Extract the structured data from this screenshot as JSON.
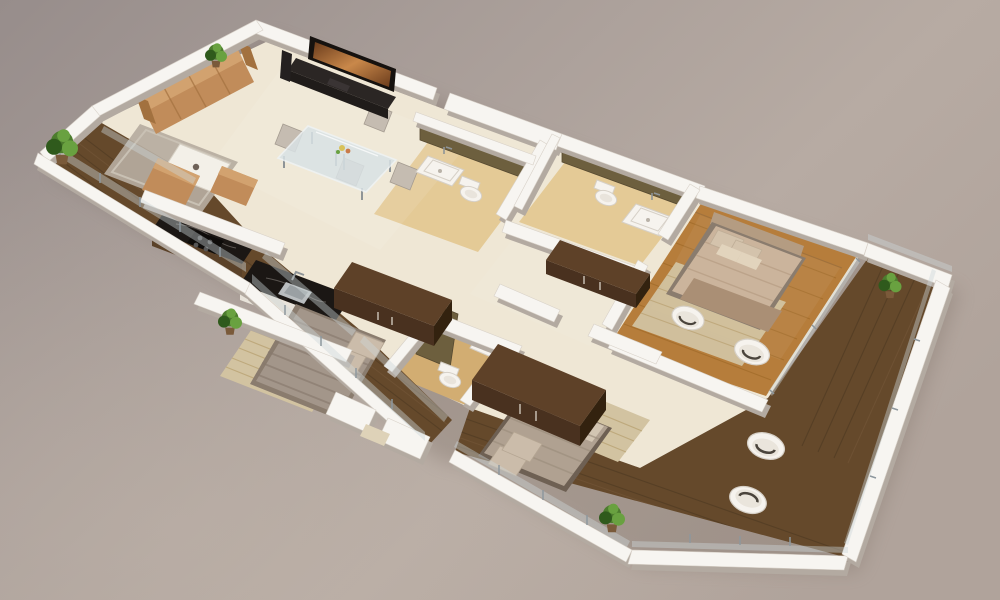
{
  "scene": {
    "title": "3D isometric cutaway floor plan render of a three-bedroom apartment",
    "style": "photorealistic architectural visualization, top-down isometric view on plain studio backdrop",
    "rooms": [
      {
        "id": "living-room",
        "label": "Living Room"
      },
      {
        "id": "dining-area",
        "label": "Dining Area"
      },
      {
        "id": "kitchen",
        "label": "Kitchen"
      },
      {
        "id": "master-bedroom",
        "label": "Master Bedroom"
      },
      {
        "id": "bedroom-2",
        "label": "Bedroom 2"
      },
      {
        "id": "bedroom-3",
        "label": "Bedroom 3"
      },
      {
        "id": "bathroom-1",
        "label": "Bathroom 1"
      },
      {
        "id": "bathroom-2",
        "label": "Bathroom 2"
      },
      {
        "id": "bathroom-3",
        "label": "Bathroom 3"
      },
      {
        "id": "balcony-west",
        "label": "West Balcony Terrace"
      },
      {
        "id": "balcony-southeast",
        "label": "Wrap-around South-East Balcony"
      },
      {
        "id": "entrance",
        "label": "Entrance Step"
      }
    ],
    "furniture": [
      "tan four-seat sofa",
      "tan armchair",
      "tan ottoman",
      "white coffee table",
      "gray area rug",
      "wall-mounted flat TV",
      "dark media cabinet",
      "floor speaker",
      "glass dining table",
      "four beige dining chairs",
      "flower centerpiece",
      "black granite kitchen counters",
      "steel sink",
      "cooktop hob",
      "three double beds with beige bedding",
      "woven bed rugs",
      "three dark-brown wardrobes",
      "hall console",
      "four white tub chairs",
      "three toilets",
      "two shower trays",
      "wash basin",
      "five green potted plants",
      "glass balcony railings"
    ],
    "counts": {
      "bedrooms": 3,
      "bathrooms": 3,
      "balconies": 3,
      "plants": 5,
      "tub_chairs": 4
    }
  },
  "colors": {
    "bg-1": "#978d8b",
    "bg-2": "#a89d98",
    "bg-3": "#b7aba3",
    "bg-4": "#b0a39b",
    "bg-light": "#c8bcb0",
    "ground-shadow": "#6f6258",
    "wall-white": "#f7f5f1",
    "wall-shadow": "#b3aaa1",
    "wall-edge": "#d8d1c8",
    "floor-cream": "#efe7d5",
    "floor-gloss": "#ffffff",
    "bath-floor": "#e4ca96",
    "bath-floor-deep": "#d2ad72",
    "tile-olive": "#6d5f3e",
    "tile-olive-dark": "#564930",
    "balcony-wood": "#65492b",
    "plank-line": "#4b3720",
    "plank-light": "#7d6040",
    "master-wood": "#b67d3b",
    "master-plank": "#96611f",
    "wardrobe-top": "#5e4128",
    "wardrobe-front": "#49311f",
    "wardrobe-side": "#33220f",
    "counter-black": "#1b1714",
    "counter-vein": "#9b968f",
    "cabinet-wood": "#5b4229",
    "sofa-tan": "#c18c5a",
    "sofa-dark": "#a2713f",
    "sofa-light": "#d2a26f",
    "rug-gray": "#b6ada0",
    "rug-border": "#c9c1b4",
    "rug-woven": "#d2c3a1",
    "rug-woven-line": "#b9a273",
    "bed-duvet": "#a3968a",
    "bed-stripe": "#877a6d",
    "bed-pillow": "#cbbcaa",
    "bed-frame": "#8a7c6e",
    "master-duvet": "#cbb49c",
    "master-blanket": "#aa8f75",
    "master-pillow": "#d4c3ac",
    "headboard": "#b49c82",
    "master-fold": "#b89f86",
    "bed3-blanket": "#b0a191",
    "bed3-fold": "#9d8e7e",
    "bed3-frame": "#6e6053",
    "bed3-sheet": "#d6c9b6",
    "fixture-white": "#f6f3ee",
    "fixture-shadow": "#d6d0c7",
    "fixture-dark": "#4a443c",
    "glass": "#ccd6d9",
    "glass-post": "#8d979d",
    "glass-table": "#d9e2e5",
    "table-edge": "#eef3f5",
    "chair-beige": "#c5bcb1",
    "chair-dark": "#a59c91",
    "plant-dark": "#2f5a1c",
    "plant-mid": "#4d7c2e",
    "plant-light": "#69a140",
    "pot-brown": "#7a5a3a",
    "tv-black": "#16120f",
    "tv-cab": "#2b2624",
    "tv-cab-dark": "#201c1a",
    "tv-warm-1": "#6b3c1c",
    "tv-warm-2": "#c9884a",
    "steel": "#b9bdbf",
    "steel-dark": "#8e9497",
    "step-beige": "#ded2b8",
    "flower-yellow": "#d8c25a",
    "flower-orange": "#c97b4a"
  }
}
